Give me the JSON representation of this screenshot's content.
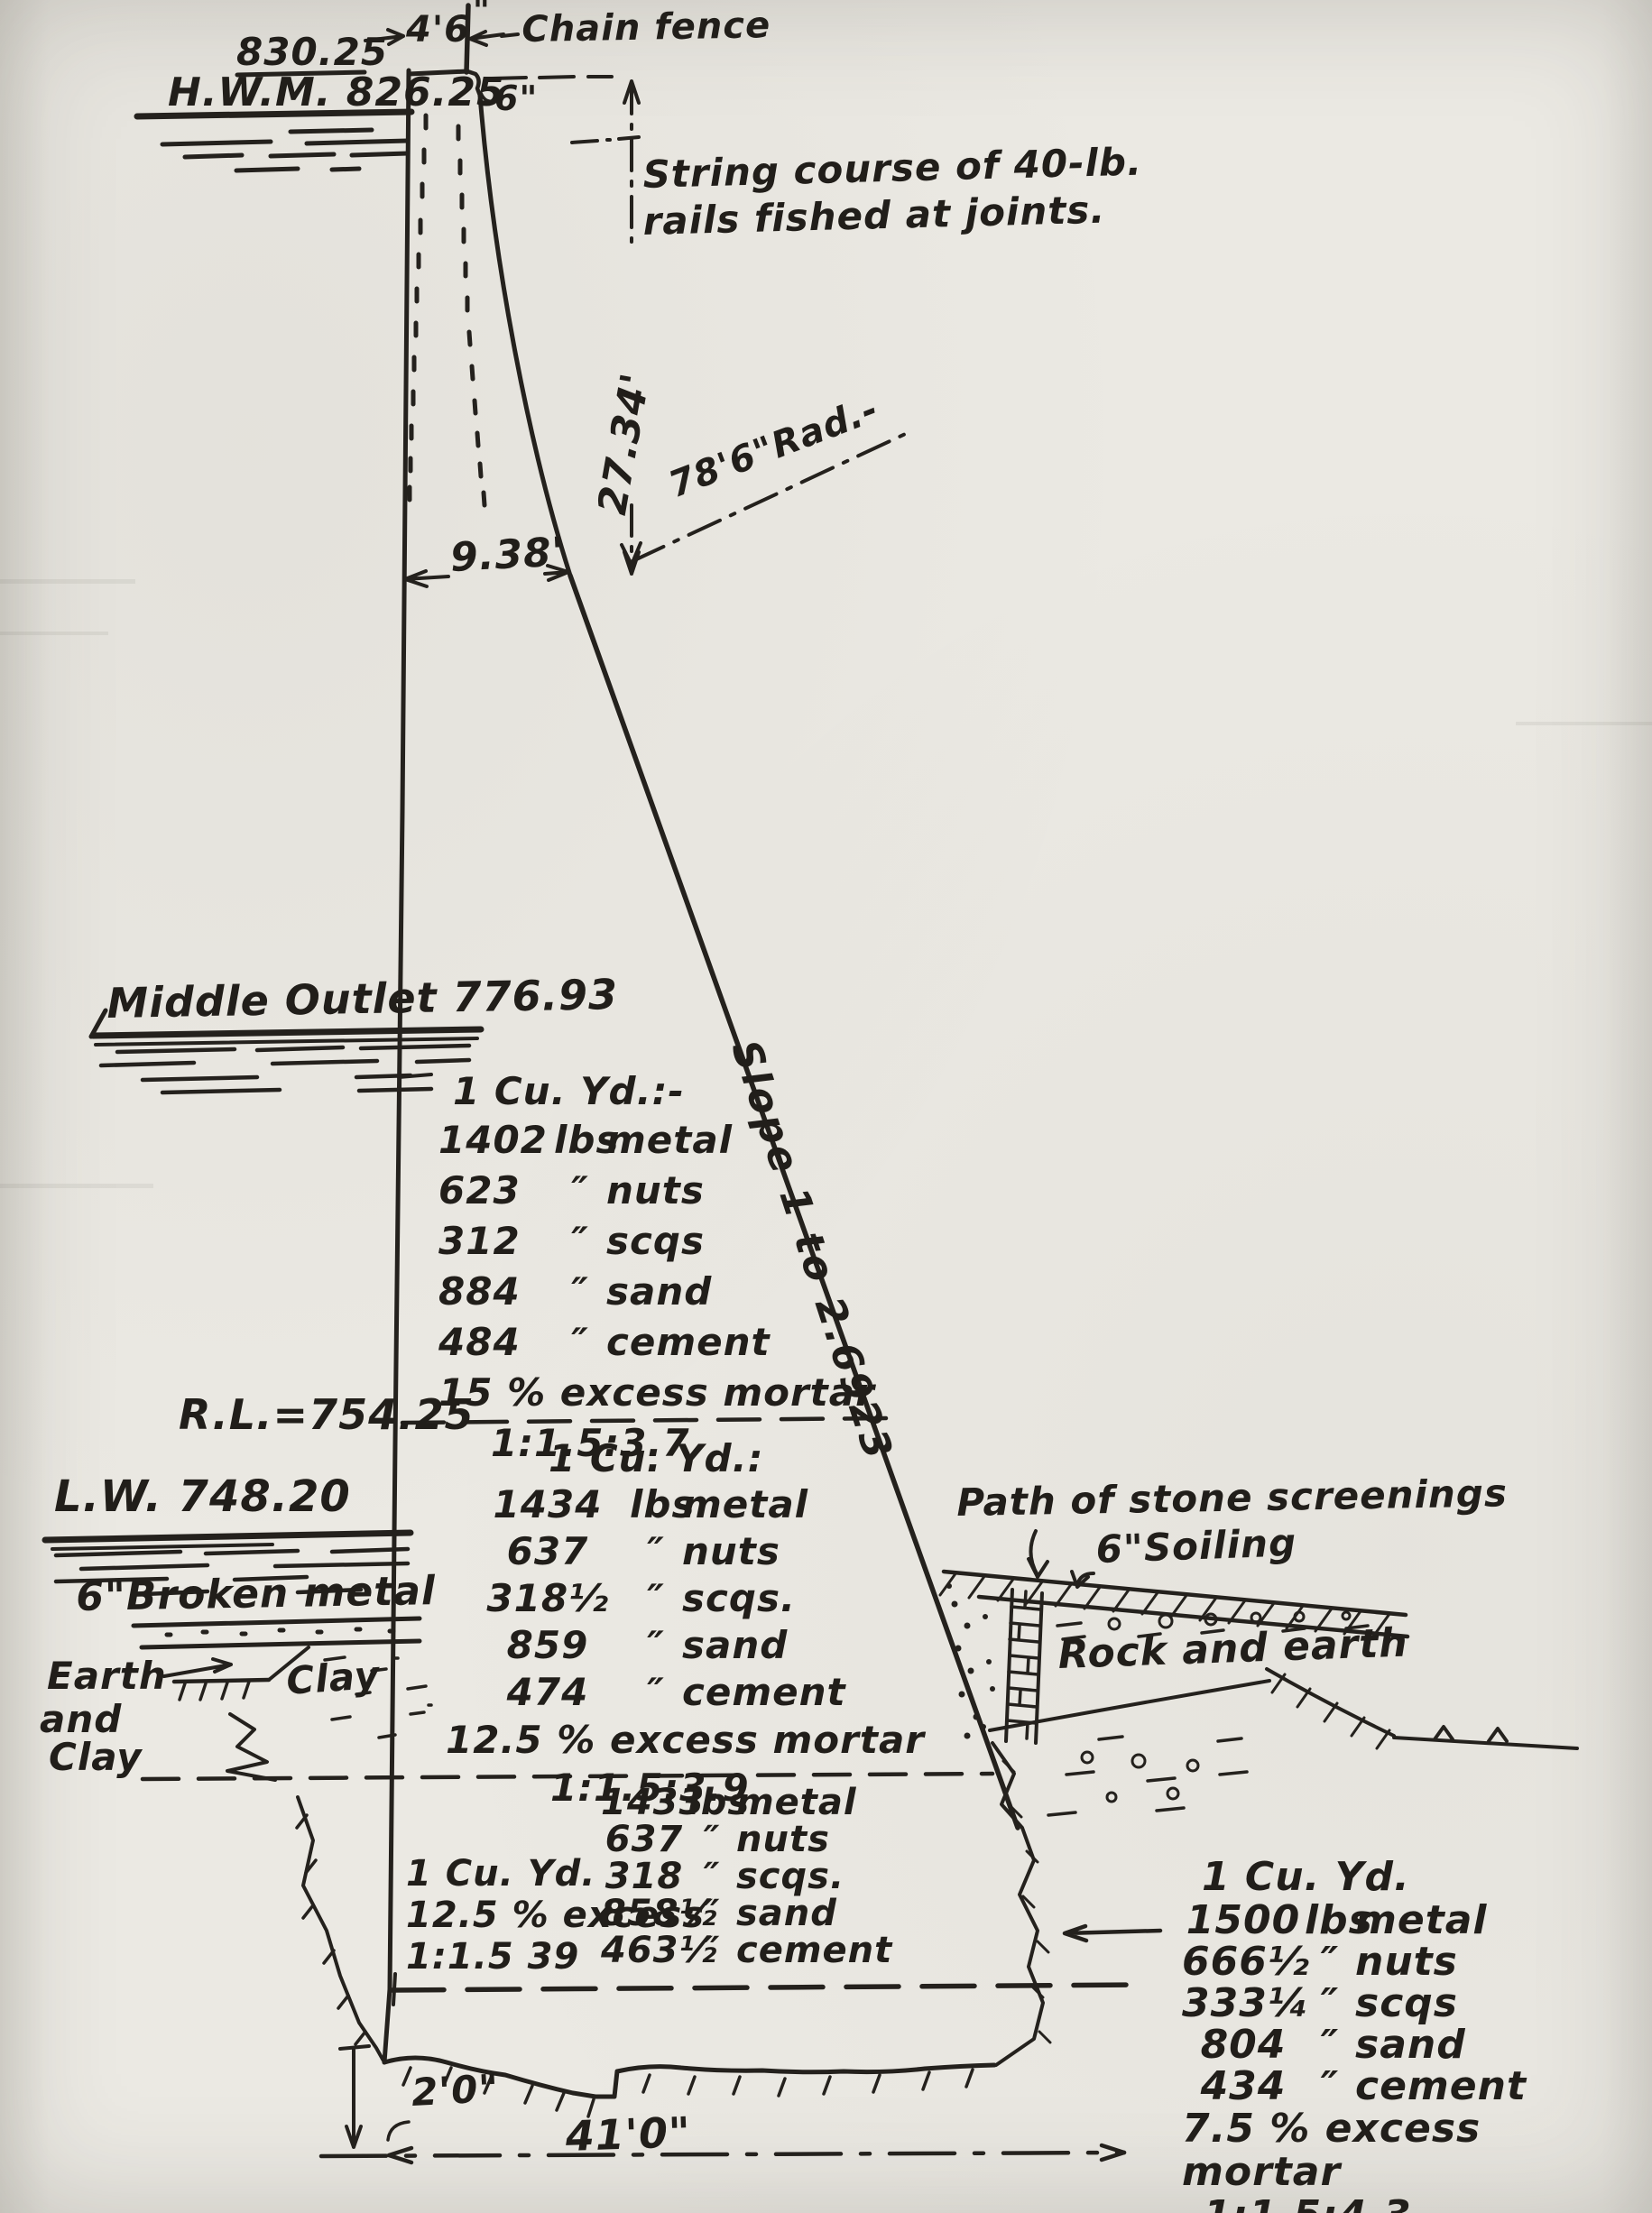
{
  "labels": {
    "crest_elev": "830.25",
    "hwm": "H.W.M. 826.25",
    "crest_width": "4'6",
    "inch_mark": "\"",
    "chain_fence": "Chain fence",
    "step": "6\"",
    "string1": "String course of 40-lb.",
    "string2": "rails fished at joints.",
    "height": "27.34'",
    "radius": "78'6\"Rad.-",
    "offset": "9.38'",
    "middle_outlet": "Middle Outlet 776.93",
    "slope": "Slope 1 to 2.6923",
    "rl": "R.L.=754.25",
    "lw": "L.W. 748.20",
    "broken_metal": "6\"Broken metal",
    "earth1": "Earth",
    "earth2": "and",
    "earth3": "Clay",
    "clay": "Clay",
    "stone_path": "Path of stone screenings",
    "soiling": "6\"Soiling",
    "rock_earth": "Rock and earth",
    "depth": "2'0\"",
    "width": "41'0\""
  },
  "mix": {
    "upper": {
      "title": "1 Cu. Yd.:-",
      "rows": [
        {
          "qty": "1402",
          "unit": "lbs",
          "mat": "metal"
        },
        {
          "qty": "623",
          "unit": "″",
          "mat": "nuts"
        },
        {
          "qty": "312",
          "unit": "″",
          "mat": "scqs"
        },
        {
          "qty": "884",
          "unit": "″",
          "mat": "sand"
        },
        {
          "qty": "484",
          "unit": "″",
          "mat": "cement"
        }
      ],
      "excess": "15 % excess mortar",
      "ratio": "1:1.5:3.7"
    },
    "middle": {
      "title": "1 Cu. Yd.:",
      "rows": [
        {
          "qty": "1434",
          "unit": "lbs",
          "mat": "metal"
        },
        {
          "qty": "637",
          "unit": "″",
          "mat": "nuts"
        },
        {
          "qty": "318½",
          "unit": "″",
          "mat": "scqs."
        },
        {
          "qty": "859",
          "unit": "″",
          "mat": "sand"
        },
        {
          "qty": "474",
          "unit": "″",
          "mat": "cement"
        }
      ],
      "excess": "12.5 % excess mortar",
      "ratio": "1:1.5:3.9"
    },
    "lower_left": {
      "title": "1 Cu. Yd.",
      "excess": "12.5 % excess",
      "ratio": "1:1.5 39"
    },
    "lower_mid": {
      "rows": [
        {
          "qty": "1433",
          "unit": "lbs",
          "mat": "metal"
        },
        {
          "qty": "637",
          "unit": "″",
          "mat": "nuts"
        },
        {
          "qty": "318",
          "unit": "″",
          "mat": "scqs."
        },
        {
          "qty": "858½",
          "unit": "″",
          "mat": "sand"
        },
        {
          "qty": "463½",
          "unit": "″",
          "mat": "cement"
        }
      ]
    },
    "lower_right": {
      "title": "1 Cu. Yd.",
      "rows": [
        {
          "qty": "1500",
          "unit": "lbs",
          "mat": "metal"
        },
        {
          "qty": "666½",
          "unit": "″",
          "mat": "nuts"
        },
        {
          "qty": "333¼",
          "unit": "″",
          "mat": "scqs"
        },
        {
          "qty": "804",
          "unit": "″",
          "mat": "sand"
        },
        {
          "qty": "434",
          "unit": "″",
          "mat": "cement"
        }
      ],
      "excess": "7.5 % excess mortar",
      "ratio": "1:1.5:4.3"
    }
  }
}
